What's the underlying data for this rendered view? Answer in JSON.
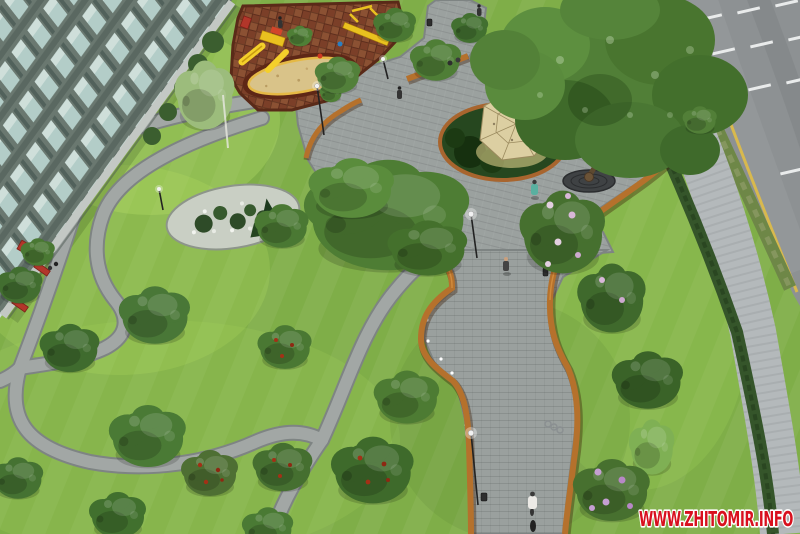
{
  "meta": {
    "description": "Aerial 3D architectural rendering of a landscaped courtyard park: apartment block at top-left, children's playground with rubber surface and sand pit, paved plaza with lattice dome pavilion under a large tree, winding footpaths, curved corten-steel ribbon benches flanking a wide central walkway, lawns with trees and lilacs, hedge, sidewalk and a road with lane markings at top-right"
  },
  "watermark": {
    "text": "WWW.ZHITOMIR.INFO",
    "text_color": "#d8101e",
    "outline_color": "#ffffff"
  },
  "palette": {
    "lawn": "#7fae48",
    "lawn_light": "#97c45c",
    "path_gray": "#a2a7a5",
    "plaza_gray": "#9aa09e",
    "corten_orange": "#b5712c",
    "playground_rubber": "#7b3f28",
    "sand": "#d9c389",
    "road_asphalt": "#8d9193",
    "road_line_yellow": "#d8b94e",
    "road_line_white": "#e9ebeb",
    "building_facade": "#68766d",
    "window_glass": "#b7d2cd",
    "hedge_green": "#35552a",
    "sidewalk_gray": "#b4b9bb",
    "foliage_mid": "#4d7c35",
    "foliage_dark": "#3a6328",
    "lilac_bloom": "#c59fd2",
    "red_fruit": "#a33016",
    "bench_red": "#b2362a",
    "dome_tan": "#dccfa2"
  }
}
